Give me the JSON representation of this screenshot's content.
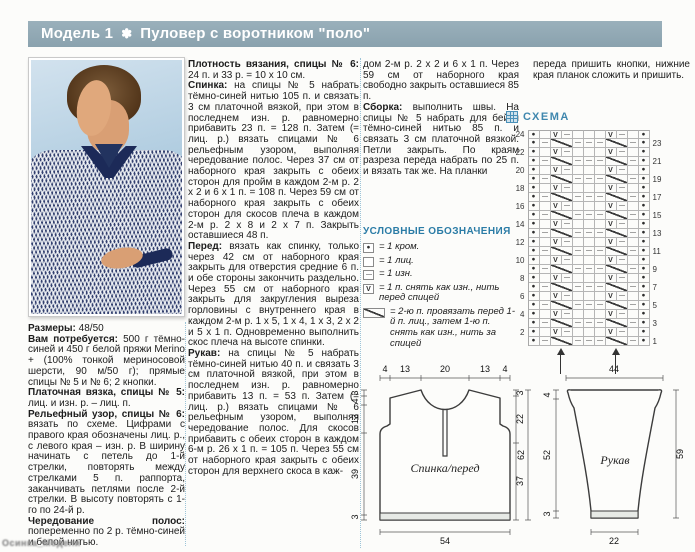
{
  "page": {
    "title_model": "Модель 1",
    "title_star": "✽",
    "title_name": "Пуловер с воротником \"поло\"",
    "title_bar_color": "#8ea7b3",
    "accent_blue": "#3f87ae"
  },
  "watermark": "Осинка_Модели",
  "columns": {
    "left": [
      {
        "lead": "Размеры:",
        "text": "48/50"
      },
      {
        "lead": "Вам потребуется:",
        "text": "500 г тёмно-синей и 450 г белой пряжи Merino + (100% тонкой мериносовой шерсти, 90 м/50 г); прямые спицы № 5 и № 6; 2 кнопки."
      },
      {
        "lead": "Платочная вязка, спицы № 5:",
        "text": "лиц. и изн. р. – лиц. п."
      },
      {
        "lead": "Рельефный узор, спицы № 6:",
        "text": "вязать по схеме. Цифрами с правого края обозначены лиц. р., с левого края – изн. р. В ширину начинать с петель до 1-й стрелки, повторять между стрелками 5 п. раппорта, заканчивать петлями после 2-й стрелки. В высоту повторять с 1-го по 24-й р."
      },
      {
        "lead": "Чередование полос:",
        "text": "попеременно по 2 р. тёмно-синей и белой нитью."
      }
    ],
    "middle": [
      {
        "lead": "Плотность вязания, спицы № 6:",
        "text": "24 п. и 33 р. = 10 х 10 см."
      },
      {
        "lead": "Спинка:",
        "text": "на спицы № 5 набрать тёмно-синей нитью 105 п. и связать 3 см платочной вязкой, при этом в последнем изн. р. равномерно прибавить 23 п. = 128 п. Затем (= лиц. р.) вязать спицами № 6 рельефным узором, выполняя чередование полос. Через 37 см от наборного края закрыть с обеих сторон для пройм в каждом 2-м р. 2 х 2 и 6 х 1 п. = 108 п. Через 59 см от наборного края закрыть с обеих сторон для скосов плеча в каждом 2-м р. 2 х 8 и 2 х 7 п. Закрыть оставшиеся 48 п."
      },
      {
        "lead": "Перед:",
        "text": "вязать как спинку, только через 42 см от наборного края закрыть для отверстия средние 6 п. и обе стороны закончить раздельно. Через 55 см от наборного края закрыть для закругления выреза горловины с внутреннего края в каждом 2-м р. 1 х 5, 1 х 4, 1 х 3, 2 х 2 и 5 х 1 п. Одновременно выполнить скос плеча на высоте спинки."
      },
      {
        "lead": "Рукав:",
        "text": "на спицы № 5 набрать тёмно-синей нитью 40 п. и связать 3 см платочной вязкой, при этом в последнем изн. р. равномерно прибавить 13 п. = 53 п. Затем (= лиц. р.) вязать спицами № 6 рельефным узором, выполняя чередование полос. Для скосов прибавить с обеих сторон в каждом 6-м р. 26 х 1 п. = 105 п. Через 55 см от наборного края закрыть с обеих сторон для верхнего скоса в каж-"
      }
    ],
    "right": [
      {
        "lead": "",
        "text": "дом 2-м р. 2 х 2 и 6 х 1 п. Через 59 см от наборного края свободно закрыть оставшиеся 85 п."
      },
      {
        "lead": "Сборка:",
        "text": "выполнить швы. На спицы № 5 набрать для бейки тёмно-синей нитью  85 п. и связать 3 см платочной вязкой. Петли закрыть. По краям разреза переда набрать по 25 п. и вязать так же. На планки"
      }
    ],
    "far_right": [
      {
        "lead": "",
        "text": "переда пришить кнопки, нижние края планок сложить и пришить."
      }
    ]
  },
  "chart": {
    "label": "СХЕМА",
    "rows": 24,
    "left_numbers": [
      24,
      22,
      20,
      18,
      16,
      14,
      12,
      10,
      8,
      6,
      4,
      2
    ],
    "right_numbers": [
      23,
      21,
      19,
      17,
      15,
      13,
      11,
      9,
      7,
      5,
      3,
      1
    ],
    "even_row_tokens": [
      "K",
      "E",
      "V",
      "P",
      "E",
      "E",
      "E",
      "V",
      "P",
      "E",
      "K"
    ],
    "odd_row_tokens": [
      "K",
      "P",
      "S",
      "P",
      "P",
      "P",
      "S",
      "P",
      "K"
    ],
    "rapport_stitches": 5,
    "arrow_offsets_px": [
      45,
      100
    ]
  },
  "legend": {
    "title": "УСЛОВНЫЕ ОБОЗНАЧЕНИЯ",
    "items": [
      {
        "symbol": "K",
        "wide": false,
        "text": "= 1 кром."
      },
      {
        "symbol": "E",
        "wide": false,
        "text": "= 1 лиц."
      },
      {
        "symbol": "P",
        "wide": false,
        "text": "= 1 изн."
      },
      {
        "symbol": "V",
        "wide": false,
        "text": "= 1 п. снять как изн., нить перед спицей"
      },
      {
        "symbol": "S",
        "wide": true,
        "text": "= 2-ю п. провязать перед 1-й п. лиц., затем 1-ю п. снять как изн., нить за спицей"
      }
    ]
  },
  "schematics": {
    "body": {
      "label": "Спинка/перед",
      "top": [
        "4",
        "13",
        "20",
        "13",
        "4"
      ],
      "left": [
        "3",
        "4",
        "13",
        "39",
        "3"
      ],
      "right": [
        "3",
        "22",
        "37"
      ],
      "total": "62",
      "bottom": "54"
    },
    "sleeve": {
      "label": "Рукав",
      "top": "44",
      "left": [
        "4",
        "52",
        "3"
      ],
      "right_total": "59",
      "bottom": "22"
    }
  }
}
